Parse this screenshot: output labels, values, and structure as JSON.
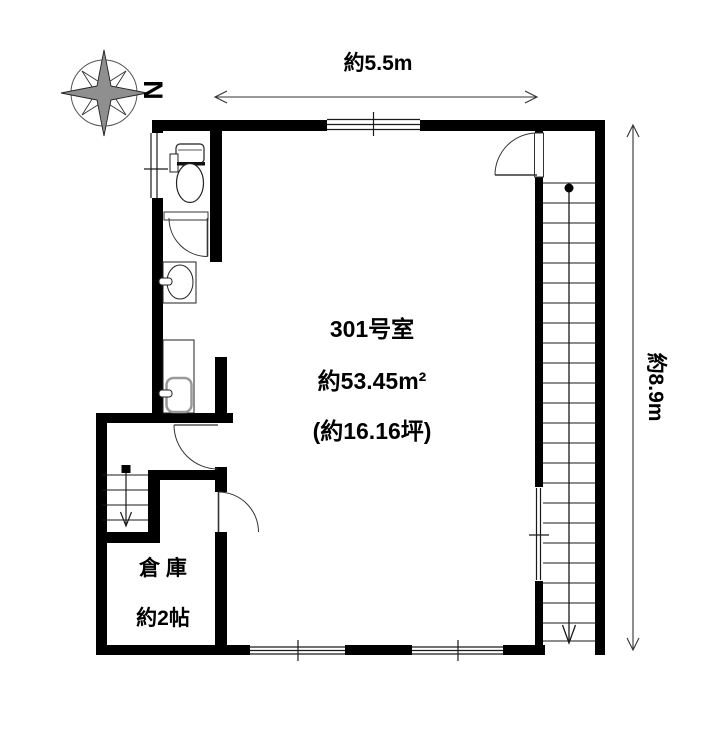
{
  "plan_title": "301号室 floor plan",
  "compass": {
    "north_label": "N"
  },
  "dimensions": {
    "width_label": "約5.5m",
    "height_label": "約8.9m"
  },
  "room": {
    "number": "301号室",
    "area_sqm": "約53.45m²",
    "area_tsubo": "(約16.16坪)"
  },
  "storage": {
    "name": "倉 庫",
    "size": "約2帖"
  },
  "icons": {
    "compass": "8-point-star-rose",
    "toilet": "toilet-plan-symbol",
    "sink": "oval-basin",
    "mini_kitchen": "rounded-basin",
    "stairs": "step-lines-with-down-arrow",
    "door": "quarter-circle-swing",
    "window": "double-line-in-wall"
  },
  "colors": {
    "wall": "#000000",
    "thin_line": "#333333",
    "compass_gray": "#8f8f8f",
    "background": "#ffffff"
  }
}
